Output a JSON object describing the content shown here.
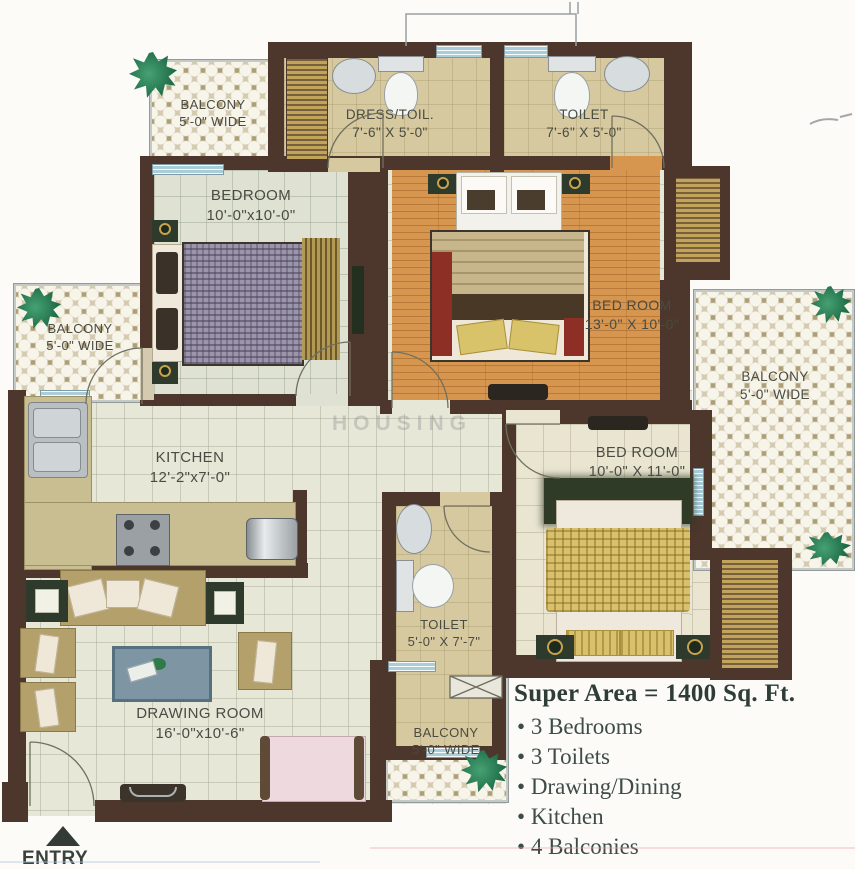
{
  "rooms": {
    "balcony_top_left": {
      "label": "BALCONY",
      "dim": "5'-0\" WIDE"
    },
    "dress_toilet": {
      "label": "DRESS/TOIL.",
      "dim": "7'-6\" X 5'-0\""
    },
    "toilet_top": {
      "label": "TOILET",
      "dim": "7'-6\" X 5'-0\""
    },
    "bedroom_small": {
      "label": "BEDROOM",
      "dim": "10'-0\"x10'-0\""
    },
    "bedroom_master": {
      "label": "BED ROOM",
      "dim": "13'-0\" X 10'-0\""
    },
    "balcony_left": {
      "label": "BALCONY",
      "dim": "5'-0\" WIDE"
    },
    "balcony_right": {
      "label": "BALCONY",
      "dim": "5'-0\" WIDE"
    },
    "kitchen": {
      "label": "KITCHEN",
      "dim": "12'-2\"x7'-0\""
    },
    "bedroom_right": {
      "label": "BED ROOM",
      "dim": "10'-0\" X 11'-0\""
    },
    "toilet_middle": {
      "label": "TOILET",
      "dim": "5'-0\" X 7'-7\""
    },
    "drawing_room": {
      "label": "DRAWING ROOM",
      "dim": "16'-0\"x10'-6\""
    },
    "balcony_bottom": {
      "label": "BALCONY",
      "dim": "5'-0\" WIDE"
    }
  },
  "summary": {
    "heading": "Super Area = 1400 Sq. Ft.",
    "items": [
      "3 Bedrooms",
      "3 Toilets",
      "Drawing/Dining",
      "Kitchen",
      "4 Balconies"
    ]
  },
  "entry_label": "ENTRY",
  "watermark": "HOUSING",
  "colors": {
    "wall": "#4d362b",
    "wood_floor": "#d69650",
    "tile_floor": "#e7e7d8",
    "balcony_lattice": "#d3cab0",
    "window": "#a9cdd9",
    "info_text": "#3e4c48"
  }
}
